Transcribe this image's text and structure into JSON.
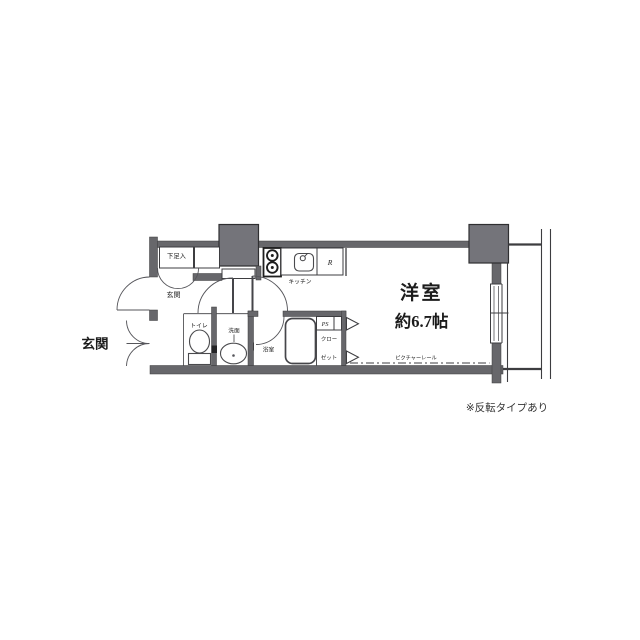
{
  "plan": {
    "labels": {
      "entrance_outside": "玄関",
      "entrance_hall": "玄関",
      "shoe_storage": "下足入",
      "kitchen": "キッチン",
      "refrigerator": "R",
      "toilet": "トイレ",
      "washroom": "洗面",
      "bathroom": "浴室",
      "pipe_space": "PS",
      "closet_line1": "クロー",
      "closet_line2": "ゼット",
      "room_name": "洋室",
      "room_size": "約6.7帖",
      "picture_rail": "ピクチャーレール"
    },
    "note": "※反転タイプあり",
    "colors": {
      "wall": "#67676b",
      "pillar": "#74747a",
      "line": "#3d3d40",
      "text": "#1c1c1c",
      "bg": "#ffffff"
    }
  }
}
